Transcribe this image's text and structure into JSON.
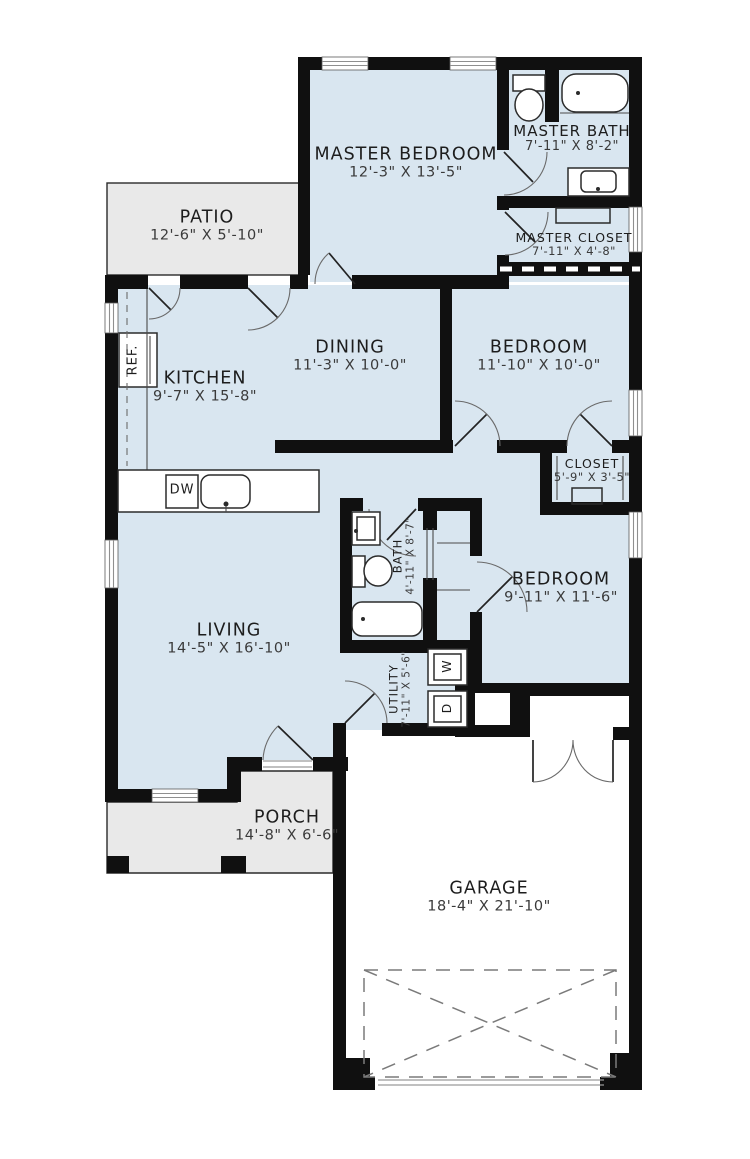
{
  "plan": {
    "title": "single-story house floor plan",
    "rooms": [
      {
        "name": "MASTER BEDROOM",
        "dims": "12'-3\" X 13'-5\""
      },
      {
        "name": "MASTER BATH",
        "dims": "7'-11\" X 8'-2\""
      },
      {
        "name": "MASTER CLOSET",
        "dims": "7'-11\" X 4'-8\""
      },
      {
        "name": "PATIO",
        "dims": "12'-6\" X 5'-10\""
      },
      {
        "name": "DINING",
        "dims": "11'-3\" X 10'-0\""
      },
      {
        "name": "BEDROOM",
        "dims": "11'-10\" X 10'-0\""
      },
      {
        "name": "KITCHEN",
        "dims": "9'-7\" X 15'-8\""
      },
      {
        "name": "CLOSET",
        "dims": "5'-9\" X 3'-5\""
      },
      {
        "name": "BATH",
        "dims": "4'-11\" X 8'-7\""
      },
      {
        "name": "BEDROOM",
        "dims": "9'-11\" X 11'-6\""
      },
      {
        "name": "LIVING",
        "dims": "14'-5\" X 16'-10\""
      },
      {
        "name": "UTILITY",
        "dims": "7'-11\" X 5'-6\""
      },
      {
        "name": "PORCH",
        "dims": "14'-8\" X 6'-6\""
      },
      {
        "name": "GARAGE",
        "dims": "18'-4\" X 21'-10\""
      }
    ],
    "appliances": {
      "refrigerator": "REF.",
      "dishwasher": "DW",
      "washer": "W",
      "dryer": "D"
    }
  },
  "colors": {
    "floor": "#d9e6f0",
    "outdoor": "#e9e9e9",
    "wall": "#101010"
  }
}
